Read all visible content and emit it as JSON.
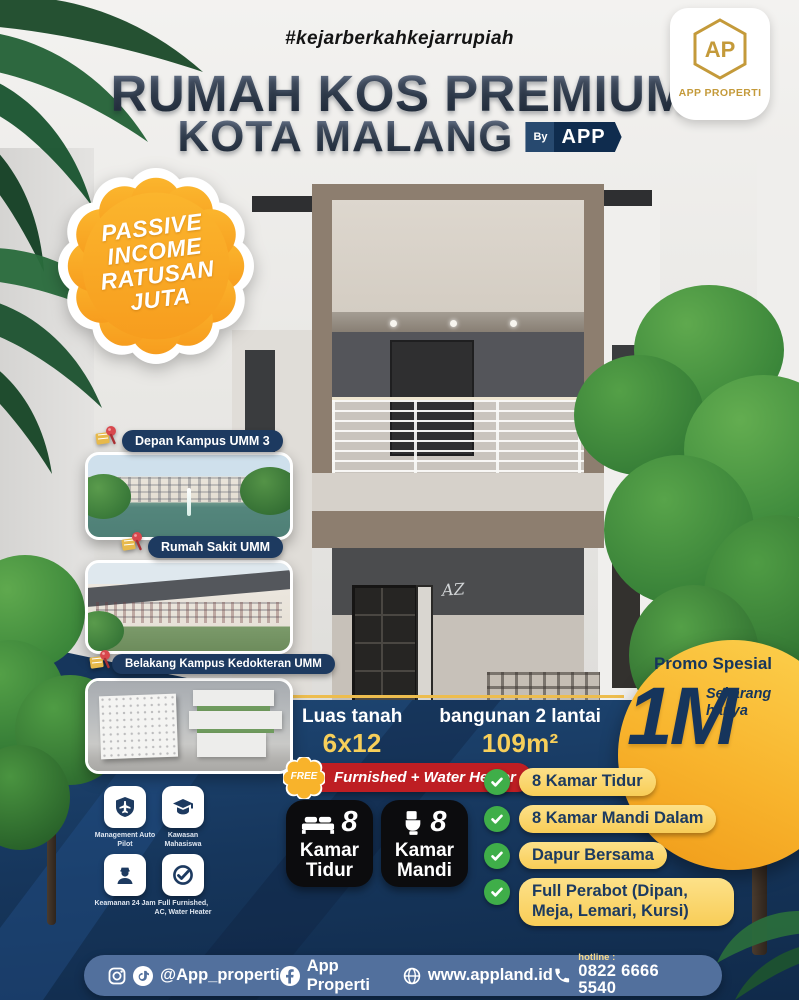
{
  "header": {
    "hashtag": "#kejarberkahkejarrupiah",
    "title_line1": "RUMAH KOS PREMIUM",
    "title_line2": "KOTA MALANG",
    "byline": {
      "by": "By",
      "brand": "APP"
    }
  },
  "brand_tab": {
    "monogram": "AP",
    "name": "APP PROPERTI"
  },
  "passive_badge": {
    "line1": "PASSIVE",
    "line2": "INCOME",
    "line3": "RATUSAN",
    "line4": "JUTA"
  },
  "location_cards": [
    {
      "label": "Depan Kampus UMM 3"
    },
    {
      "label": "Rumah Sakit UMM"
    },
    {
      "label": "Belakang Kampus Kedokteran UMM"
    }
  ],
  "house": {
    "signature": "AZ"
  },
  "promo": {
    "title": "Promo Spesial",
    "subtitle_line1": "Sekarang",
    "subtitle_line2": "hanya",
    "price": "1M"
  },
  "specs": [
    {
      "label": "Luas tanah",
      "value": "6x12 (72m²)"
    },
    {
      "label": "bangunan 2 lantai",
      "value": "109m²"
    }
  ],
  "free_offer": {
    "badge": "FREE",
    "text": "Furnished + Water Heater"
  },
  "room_badges": [
    {
      "count": "8",
      "label_line1": "Kamar",
      "label_line2": "Tidur"
    },
    {
      "count": "8",
      "label_line1": "Kamar",
      "label_line2": "Mandi"
    }
  ],
  "features": [
    {
      "text": "8 Kamar Tidur"
    },
    {
      "text": "8 Kamar Mandi Dalam"
    },
    {
      "text": "Dapur Bersama"
    },
    {
      "text": "Full Perabot (Dipan, Meja, Lemari, Kursi)"
    }
  ],
  "amenities": [
    {
      "label": "Management Auto Pilot"
    },
    {
      "label": "Kawasan Mahasiswa"
    },
    {
      "label": "Keamanan 24 Jam"
    },
    {
      "label": "Full Furnished, AC, Water Heater"
    }
  ],
  "footer": {
    "instagram": "@App_properti",
    "facebook": "App Properti",
    "website": "www.appland.id",
    "hotline_label": "hotline :",
    "hotline_number": "0822 6666 5540"
  },
  "colors": {
    "navy": "#16355c",
    "gold": "#f6a824",
    "yellow_pill": "#fbd45f",
    "red_pill": "#be1e23",
    "green_check": "#3fae49",
    "footer_blue": "#52709d",
    "logo_gold": "#c49a3a"
  }
}
